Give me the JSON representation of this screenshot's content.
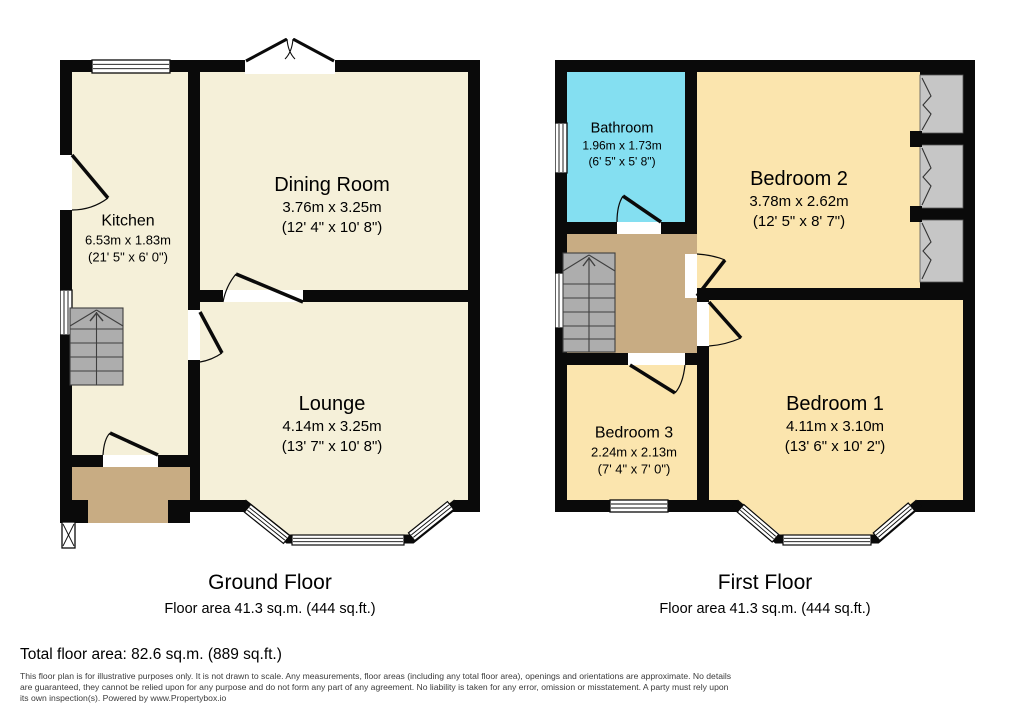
{
  "ground_floor": {
    "title": "Ground Floor",
    "area_label": "Floor area 41.3 sq.m. (444 sq.ft.)",
    "rooms": {
      "kitchen": {
        "name": "Kitchen",
        "metric": "6.53m x 1.83m",
        "imperial": "(21' 5\" x 6' 0\")"
      },
      "dining": {
        "name": "Dining Room",
        "metric": "3.76m x 3.25m",
        "imperial": "(12' 4\" x 10' 8\")"
      },
      "lounge": {
        "name": "Lounge",
        "metric": "4.14m x 3.25m",
        "imperial": "(13' 7\" x 10' 8\")"
      }
    }
  },
  "first_floor": {
    "title": "First Floor",
    "area_label": "Floor area 41.3 sq.m. (444 sq.ft.)",
    "rooms": {
      "bathroom": {
        "name": "Bathroom",
        "metric": "1.96m x 1.73m",
        "imperial": "(6' 5\" x 5' 8\")"
      },
      "bedroom2": {
        "name": "Bedroom 2",
        "metric": "3.78m x 2.62m",
        "imperial": "(12' 5\" x 8' 7\")"
      },
      "bedroom3": {
        "name": "Bedroom 3",
        "metric": "2.24m x 2.13m",
        "imperial": "(7' 4\" x 7' 0\")"
      },
      "bedroom1": {
        "name": "Bedroom 1",
        "metric": "4.11m x 3.10m",
        "imperial": "(13' 6\" x 10' 2\")"
      }
    }
  },
  "footer": {
    "total_label": "Total floor area: 82.6 sq.m. (889 sq.ft.)",
    "disclaimer": "This floor plan is for illustrative purposes only. It is not drawn to scale. Any measurements, floor areas (including any total floor area), openings and orientations are approximate. No details are guaranteed, they cannot be relied upon for any purpose and do not form any part of any agreement. No liability is taken for any error, omission or misstatement. A party must rely upon its own inspection(s). Powered by www.Propertybox.io"
  },
  "colors": {
    "wall": "#0a0a0a",
    "ground_room_fill": "#f5f0d9",
    "bedroom_fill": "#fbe5ae",
    "bathroom_fill": "#84dff1",
    "hall_landing_fill": "#c8ac83",
    "stairs_fill": "#adadad",
    "wardrobe_fill": "#c6c6c6",
    "background": "#ffffff"
  }
}
